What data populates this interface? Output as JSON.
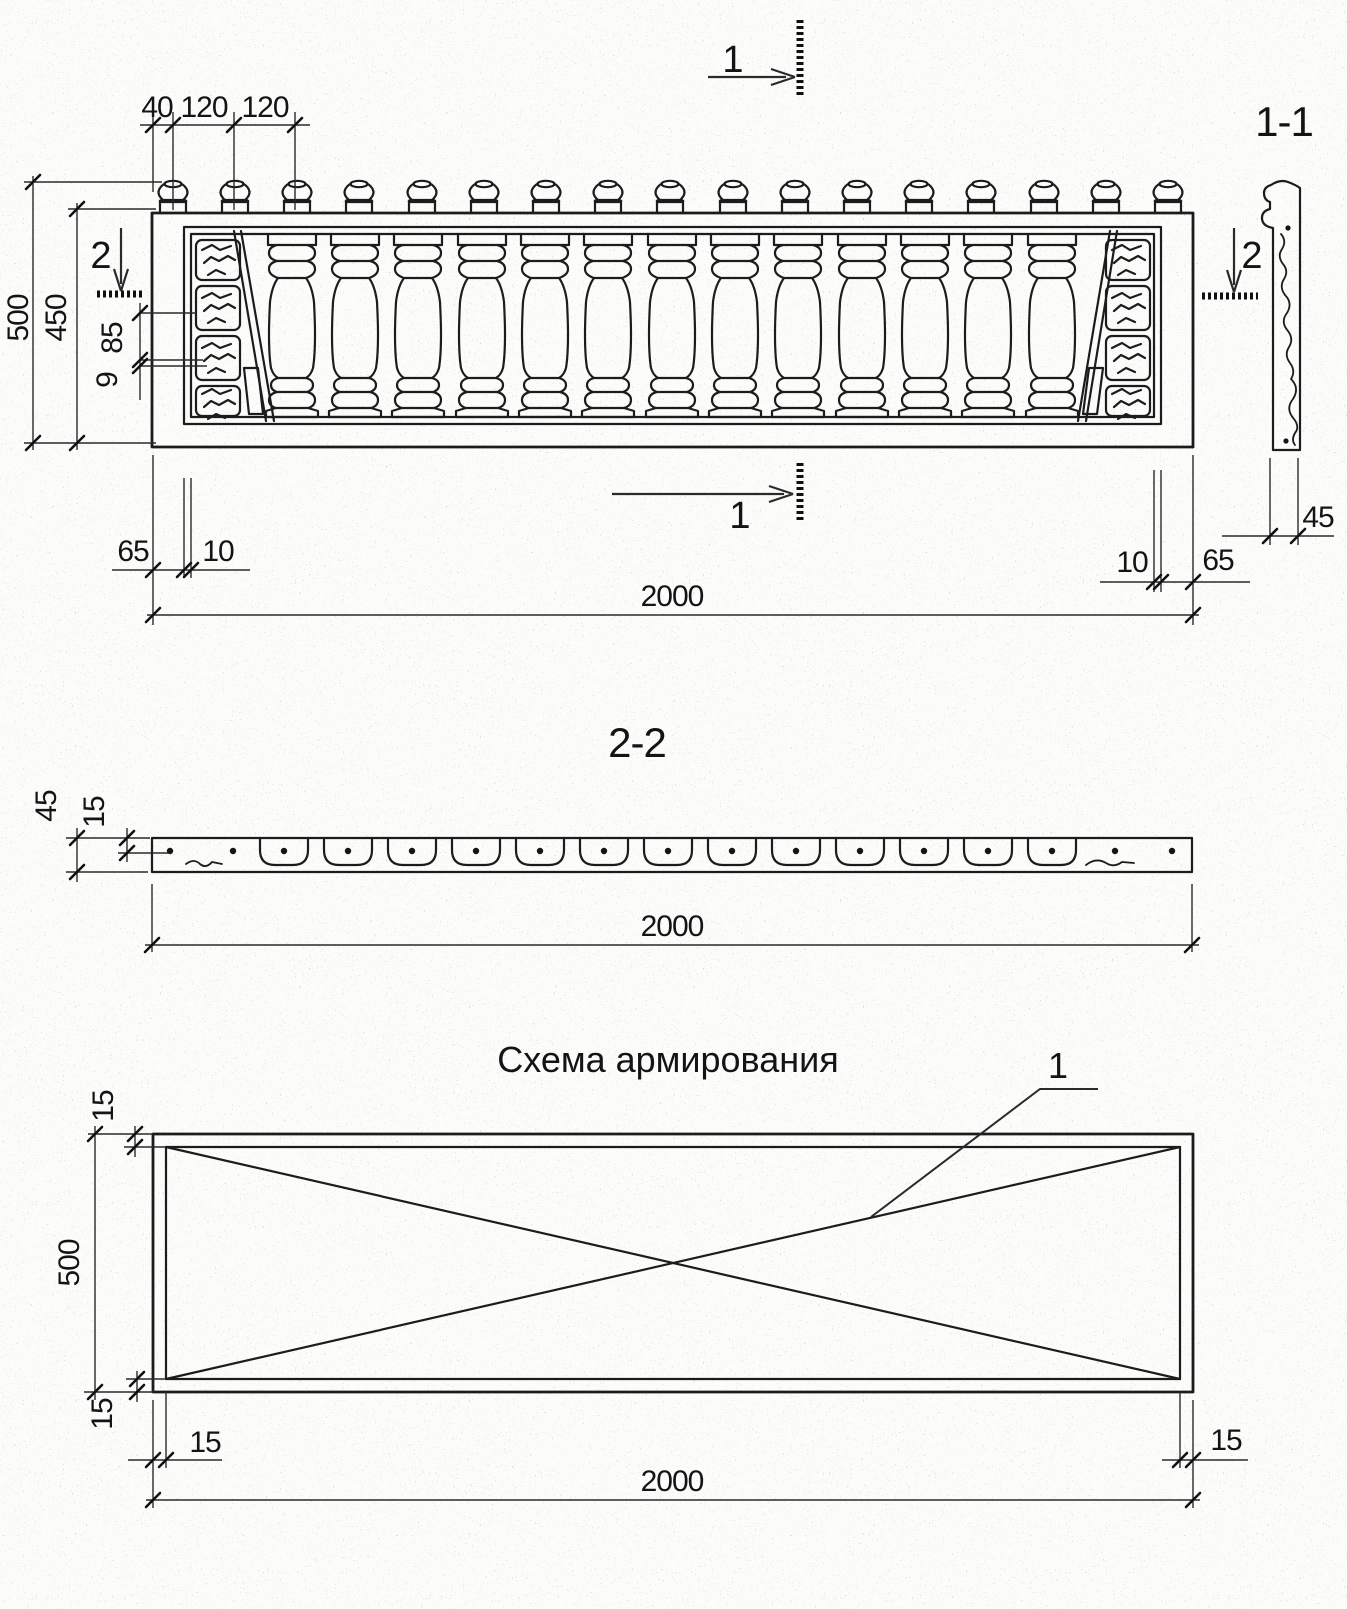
{
  "sheet": {
    "elevation": {
      "section_mark_top": "1",
      "section_mark_bottom": "1",
      "section_mark_left": "2",
      "section_mark_right": "2",
      "dim_40": "40",
      "dim_120a": "120",
      "dim_120b": "120",
      "dim_500": "500",
      "dim_450": "450",
      "dim_85": "85",
      "dim_9": "9",
      "dim_left_65": "65",
      "dim_left_10": "10",
      "dim_right_10": "10",
      "dim_right_65": "65",
      "dim_2000": "2000"
    },
    "section_1_1": {
      "title": "1-1",
      "dim_45": "45"
    },
    "section_2_2": {
      "title": "2-2",
      "dim_45": "45",
      "dim_15": "15",
      "dim_2000": "2000"
    },
    "reinforcement": {
      "title": "Схема армирования",
      "callout_1": "1",
      "dim_top_15": "15",
      "dim_500": "500",
      "dim_bottom_15": "15",
      "dim_left_15": "15",
      "dim_right_15": "15",
      "dim_2000": "2000"
    }
  }
}
